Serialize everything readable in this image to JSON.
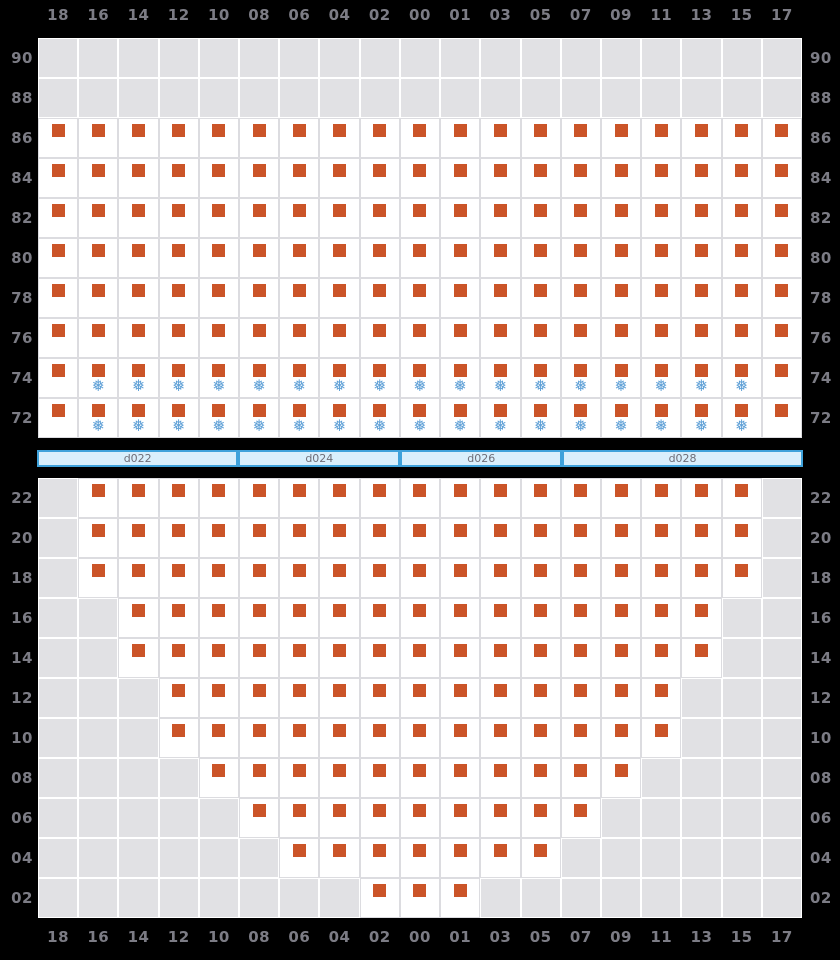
{
  "chart_data": {
    "type": "heatmap",
    "title": "",
    "xlabel": "",
    "ylabel": "",
    "grid": "on",
    "columns": [
      "18",
      "16",
      "14",
      "12",
      "10",
      "08",
      "06",
      "04",
      "02",
      "00",
      "01",
      "03",
      "05",
      "07",
      "09",
      "11",
      "13",
      "15",
      "17"
    ],
    "top_panel": {
      "y_labels": [
        "90",
        "88",
        "86",
        "84",
        "82",
        "80",
        "78",
        "76",
        "74",
        "72"
      ],
      "rows": [
        {
          "y": "90",
          "white": null,
          "snow": null
        },
        {
          "y": "88",
          "white": null,
          "snow": null
        },
        {
          "y": "86",
          "white": [
            0,
            18
          ],
          "snow": null
        },
        {
          "y": "84",
          "white": [
            0,
            18
          ],
          "snow": null
        },
        {
          "y": "82",
          "white": [
            0,
            18
          ],
          "snow": null
        },
        {
          "y": "80",
          "white": [
            0,
            18
          ],
          "snow": null
        },
        {
          "y": "78",
          "white": [
            0,
            18
          ],
          "snow": null
        },
        {
          "y": "76",
          "white": [
            0,
            18
          ],
          "snow": null
        },
        {
          "y": "74",
          "white": [
            0,
            18
          ],
          "snow": [
            1,
            17
          ]
        },
        {
          "y": "72",
          "white": [
            0,
            18
          ],
          "snow": [
            1,
            17
          ]
        }
      ]
    },
    "day_bar": {
      "segments": [
        {
          "label": "d022",
          "cols": 5
        },
        {
          "label": "d024",
          "cols": 4
        },
        {
          "label": "d026",
          "cols": 4
        },
        {
          "label": "d028",
          "cols": 6
        }
      ]
    },
    "bottom_panel": {
      "y_labels": [
        "22",
        "20",
        "18",
        "16",
        "14",
        "12",
        "10",
        "08",
        "06",
        "04",
        "02"
      ],
      "rows": [
        {
          "y": "22",
          "white": [
            1,
            17
          ],
          "snow": null
        },
        {
          "y": "20",
          "white": [
            1,
            17
          ],
          "snow": null
        },
        {
          "y": "18",
          "white": [
            1,
            17
          ],
          "snow": null
        },
        {
          "y": "16",
          "white": [
            2,
            16
          ],
          "snow": null
        },
        {
          "y": "14",
          "white": [
            2,
            16
          ],
          "snow": null
        },
        {
          "y": "12",
          "white": [
            3,
            15
          ],
          "snow": null
        },
        {
          "y": "10",
          "white": [
            3,
            15
          ],
          "snow": null
        },
        {
          "y": "08",
          "white": [
            4,
            14
          ],
          "snow": null
        },
        {
          "y": "06",
          "white": [
            5,
            13
          ],
          "snow": null
        },
        {
          "y": "04",
          "white": [
            6,
            12
          ],
          "snow": null
        },
        {
          "y": "02",
          "white": [
            8,
            10
          ],
          "snow": null
        }
      ]
    },
    "icons": {
      "snowflake": "❅",
      "marker": "filled-square"
    },
    "marker_in_every_white_cell": true
  },
  "colors": {
    "background": "#000000",
    "grid_gray": "#e1e1e4",
    "grid_line": "#ffffff",
    "white_cell": "#ffffff",
    "white_cell_border": "#dcdce0",
    "marker_orange": "#cb5428",
    "snowflake_blue": "#5d9fd6",
    "axis_label": "#7c7c85",
    "bar_border": "#3fa2db",
    "bar_fill": "#d9effc",
    "bar_text": "#6e6e78"
  }
}
